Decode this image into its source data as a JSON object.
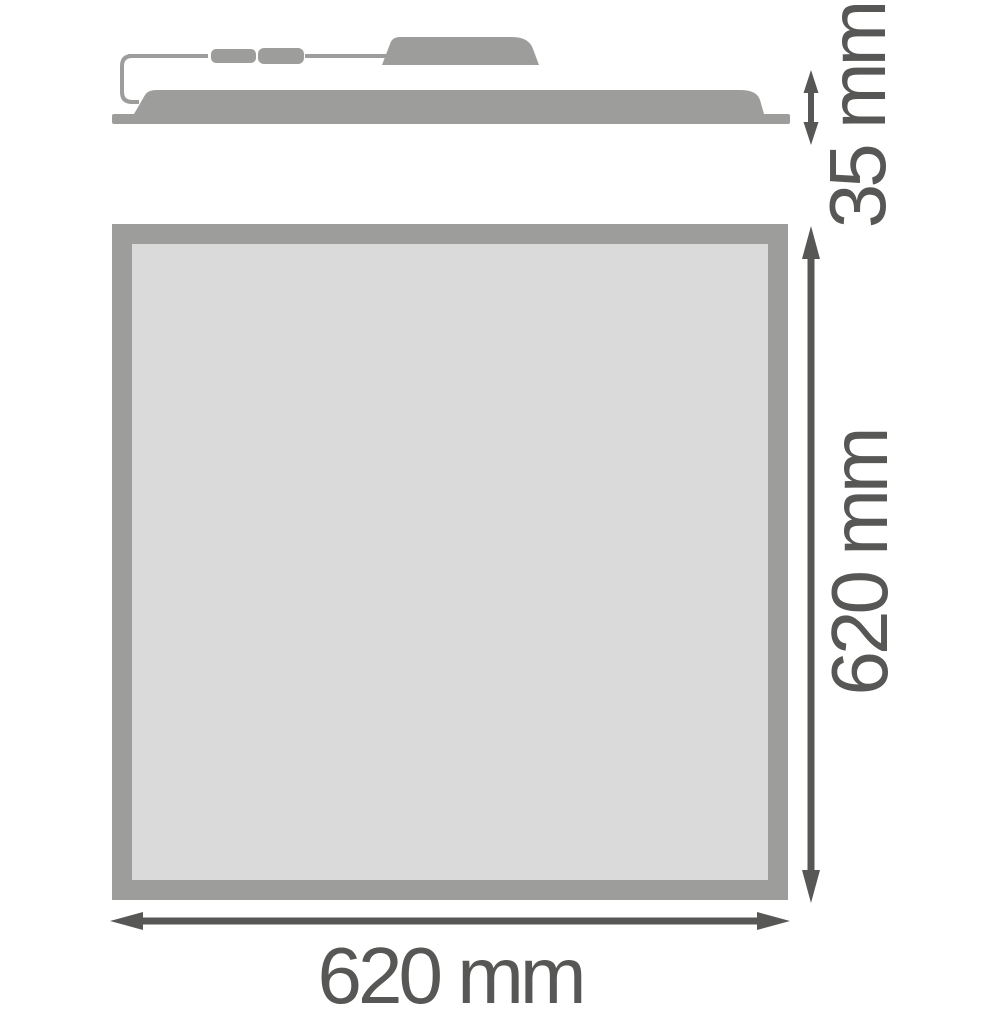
{
  "drawing": {
    "unit": "mm",
    "dimensions": {
      "thickness": {
        "value": 35,
        "label": "35 mm"
      },
      "height": {
        "value": 620,
        "label": "620 mm"
      },
      "width": {
        "value": 620,
        "label": "620 mm"
      }
    },
    "colors": {
      "shape_gray": "#9d9d9c",
      "panel_fill": "#dadada",
      "dimension_color": "#575756",
      "background": "#ffffff"
    }
  }
}
